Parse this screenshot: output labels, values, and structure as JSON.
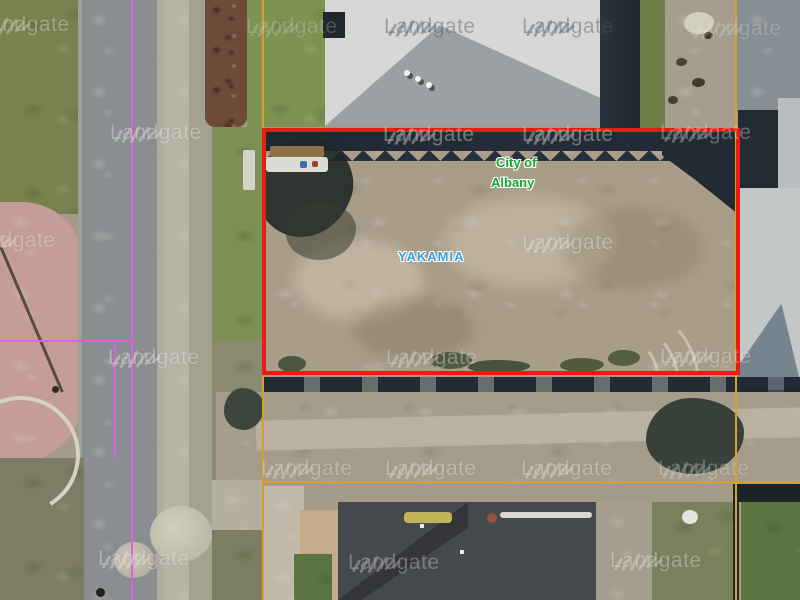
{
  "map": {
    "watermark_text": "Landgate",
    "labels": {
      "authority_line1": "City of",
      "authority_line2": "Albany",
      "authority_color": "#15a42f",
      "locality": "YAKAMIA",
      "locality_color": "#3c9ede"
    },
    "overlay_colors": {
      "parcel_highlight": "#ea1c11",
      "lot_boundary": "#d99e2e",
      "road_centreline": "#e45fe0"
    },
    "watermarks": [
      {
        "x": -22,
        "y": 14,
        "variant": "light",
        "opacity": 0.55
      },
      {
        "x": 246,
        "y": 16,
        "variant": "light",
        "opacity": 0.35
      },
      {
        "x": 384,
        "y": 16,
        "variant": "dark",
        "opacity": 0.8
      },
      {
        "x": 522,
        "y": 16,
        "variant": "dark",
        "opacity": 0.8
      },
      {
        "x": 690,
        "y": 18,
        "variant": "light",
        "opacity": 0.35
      },
      {
        "x": 110,
        "y": 122,
        "variant": "light",
        "opacity": 0.6
      },
      {
        "x": 383,
        "y": 124,
        "variant": "light",
        "opacity": 0.6
      },
      {
        "x": 522,
        "y": 124,
        "variant": "light",
        "opacity": 0.6
      },
      {
        "x": 660,
        "y": 122,
        "variant": "light",
        "opacity": 0.5
      },
      {
        "x": -36,
        "y": 230,
        "variant": "light",
        "opacity": 0.55
      },
      {
        "x": 522,
        "y": 232,
        "variant": "light",
        "opacity": 0.6
      },
      {
        "x": 108,
        "y": 347,
        "variant": "light",
        "opacity": 0.6
      },
      {
        "x": 386,
        "y": 347,
        "variant": "light",
        "opacity": 0.55
      },
      {
        "x": 660,
        "y": 346,
        "variant": "light",
        "opacity": 0.55
      },
      {
        "x": 261,
        "y": 458,
        "variant": "light",
        "opacity": 0.55
      },
      {
        "x": 385,
        "y": 458,
        "variant": "light",
        "opacity": 0.6
      },
      {
        "x": 521,
        "y": 458,
        "variant": "light",
        "opacity": 0.6
      },
      {
        "x": 658,
        "y": 458,
        "variant": "light",
        "opacity": 0.45
      },
      {
        "x": 98,
        "y": 548,
        "variant": "light",
        "opacity": 0.55
      },
      {
        "x": 348,
        "y": 552,
        "variant": "light",
        "opacity": 0.5
      },
      {
        "x": 610,
        "y": 550,
        "variant": "light",
        "opacity": 0.55
      }
    ]
  }
}
